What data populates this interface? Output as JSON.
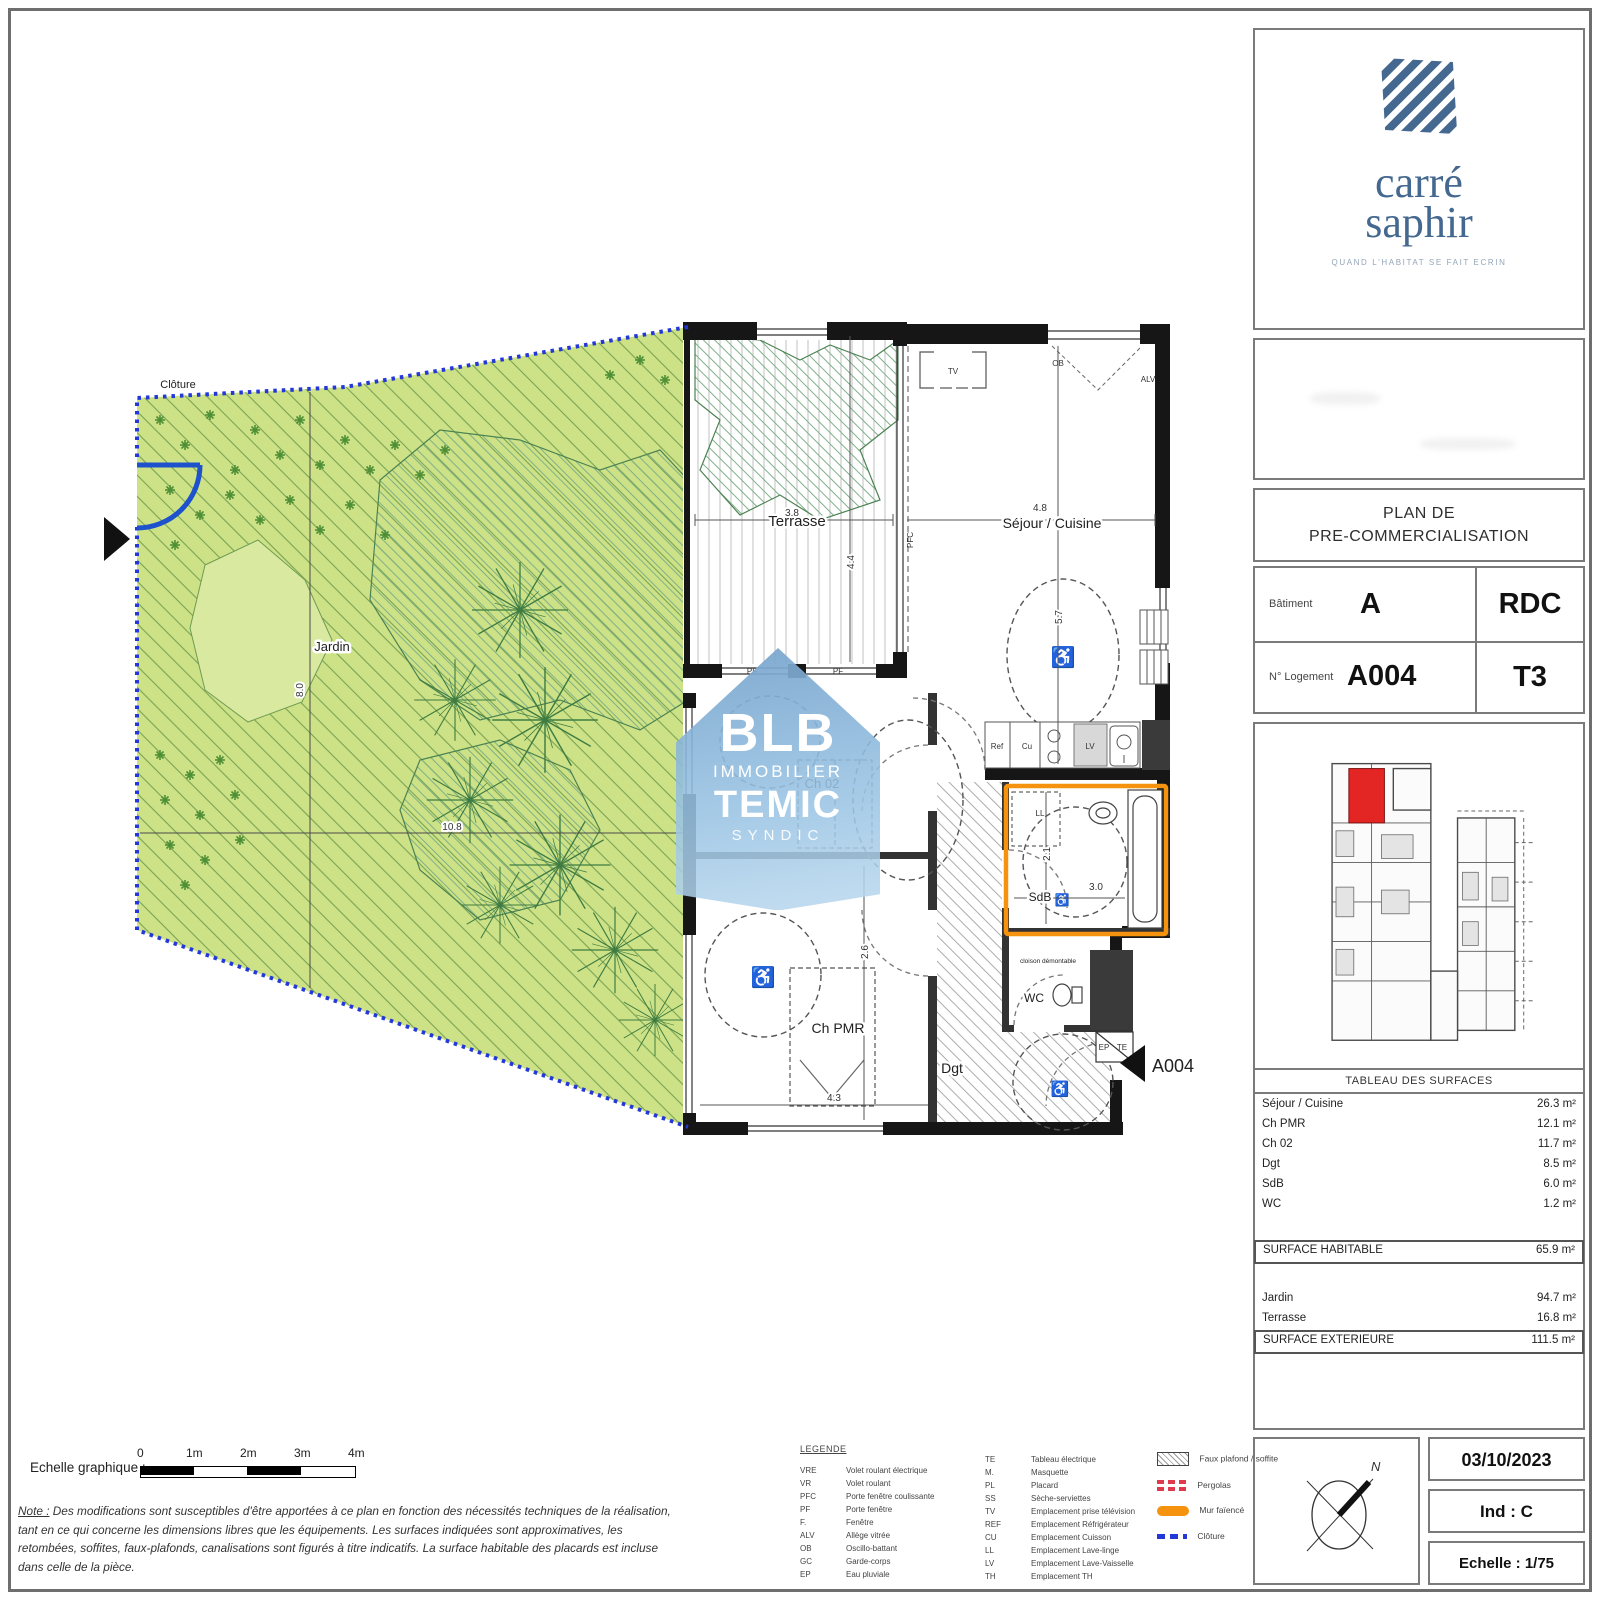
{
  "branding": {
    "logo_top": "carré",
    "logo_bottom": "saphir",
    "tagline": "QUAND L'HABITAT SE FAIT ECRIN"
  },
  "title_block": {
    "line1": "PLAN DE",
    "line2": "PRE-COMMERCIALISATION"
  },
  "info": {
    "batiment_label": "Bâtiment",
    "batiment_value": "A",
    "niveau_value": "RDC",
    "logement_label": "N° Logement",
    "logement_value": "A004",
    "type_value": "T3"
  },
  "surfaces": {
    "title": "TABLEAU DES SURFACES",
    "rows": [
      {
        "label": "Séjour / Cuisine",
        "value": "26.3 m²"
      },
      {
        "label": "Ch PMR",
        "value": "12.1 m²"
      },
      {
        "label": "Ch 02",
        "value": "11.7 m²"
      },
      {
        "label": "Dgt",
        "value": "8.5 m²"
      },
      {
        "label": "SdB",
        "value": "6.0 m²"
      },
      {
        "label": "WC",
        "value": "1.2 m²"
      }
    ],
    "habitable": {
      "label": "SURFACE HABITABLE",
      "value": "65.9 m²"
    },
    "ext_rows": [
      {
        "label": "Jardin",
        "value": "94.7 m²"
      },
      {
        "label": "Terrasse",
        "value": "16.8 m²"
      }
    ],
    "exterieure": {
      "label": "SURFACE EXTERIEURE",
      "value": "111.5 m²"
    }
  },
  "stamp": {
    "date": "03/10/2023",
    "ind": "Ind : C",
    "echelle": "Echelle : 1/75",
    "north": "N"
  },
  "scalebar": {
    "label": "Echelle graphique :",
    "ticks": [
      "0",
      "1m",
      "2m",
      "3m",
      "4m"
    ]
  },
  "note": {
    "label": "Note :",
    "text": "Des modifications sont susceptibles d'être apportées à ce plan en fonction des nécessités techniques de la réalisation, tant en ce qui concerne les dimensions libres que les équipements. Les surfaces indiquées sont approximatives, les retombées, soffites, faux-plafonds, canalisations sont figurés à titre indicatifs. La surface habitable des placards est incluse dans celle de la pièce."
  },
  "legend": {
    "title": "LEGENDE",
    "col1": [
      {
        "abbr": "VRE",
        "label": "Volet roulant électrique"
      },
      {
        "abbr": "VR",
        "label": "Volet roulant"
      },
      {
        "abbr": "PFC",
        "label": "Porte fenêtre coulissante"
      },
      {
        "abbr": "PF",
        "label": "Porte fenêtre"
      },
      {
        "abbr": "F.",
        "label": "Fenêtre"
      },
      {
        "abbr": "ALV",
        "label": "Allège vitrée"
      },
      {
        "abbr": "OB",
        "label": "Oscillo-battant"
      },
      {
        "abbr": "GC",
        "label": "Garde-corps"
      },
      {
        "abbr": "EP",
        "label": "Eau pluviale"
      }
    ],
    "col2": [
      {
        "abbr": "TE",
        "label": "Tableau électrique"
      },
      {
        "abbr": "M.",
        "label": "Masquette"
      },
      {
        "abbr": "PL",
        "label": "Placard"
      },
      {
        "abbr": "SS",
        "label": "Sèche-serviettes"
      },
      {
        "abbr": "TV",
        "label": "Emplacement prise télévision"
      },
      {
        "abbr": "REF",
        "label": "Emplacement Réfrigérateur"
      },
      {
        "abbr": "CU",
        "label": "Emplacement Cuisson"
      },
      {
        "abbr": "LL",
        "label": "Emplacement Lave-linge"
      },
      {
        "abbr": "LV",
        "label": "Emplacement Lave-Vaisselle"
      },
      {
        "abbr": "TH",
        "label": "Emplacement TH"
      }
    ],
    "symbols": [
      {
        "label": "Faux plafond / soffite"
      },
      {
        "label": "Pergolas"
      },
      {
        "label": "Mur faïencé"
      },
      {
        "label": "Clôture"
      }
    ]
  },
  "plan": {
    "labels": {
      "cloture": "Clôture",
      "jardin": "Jardin",
      "terrasse": "Terrasse",
      "sejour": "Séjour / Cuisine",
      "ch02": "Ch 02",
      "chpmr": "Ch PMR",
      "sdb": "SdB",
      "wc": "WC",
      "dgt": "Dgt",
      "unit": "A004",
      "cloison": "cloison démontable",
      "tv": "TV",
      "ob": "OB",
      "alv": "ALV",
      "pf": "PF",
      "pfc": "PFC",
      "ref": "Ref",
      "cu": "Cu",
      "lv": "LV",
      "ll": "LL",
      "ep": "EP",
      "te": "TE"
    },
    "dims": {
      "jardin_w": "10.8",
      "jardin_h": "8.0",
      "terrasse_w": "3.8",
      "terrasse_h": "4.4",
      "sejour_w": "4.8",
      "sejour_h": "5.7",
      "chpmr_w": "4.3",
      "chpmr_h": "2.6",
      "sdb_w": "3.0",
      "sdb_h": "2.1"
    }
  },
  "watermark": {
    "l1": "BLB",
    "l2": "IMMOBILIER",
    "l3": "TEMIC",
    "l4": "SYNDIC"
  },
  "colors": {
    "garden": "#cde286",
    "cloture_blue": "#2438d8",
    "orange": "#f5920e",
    "unit_red": "#e32524",
    "logo_blue": "#44688f",
    "watermark_blue": "#8fb9dc"
  }
}
